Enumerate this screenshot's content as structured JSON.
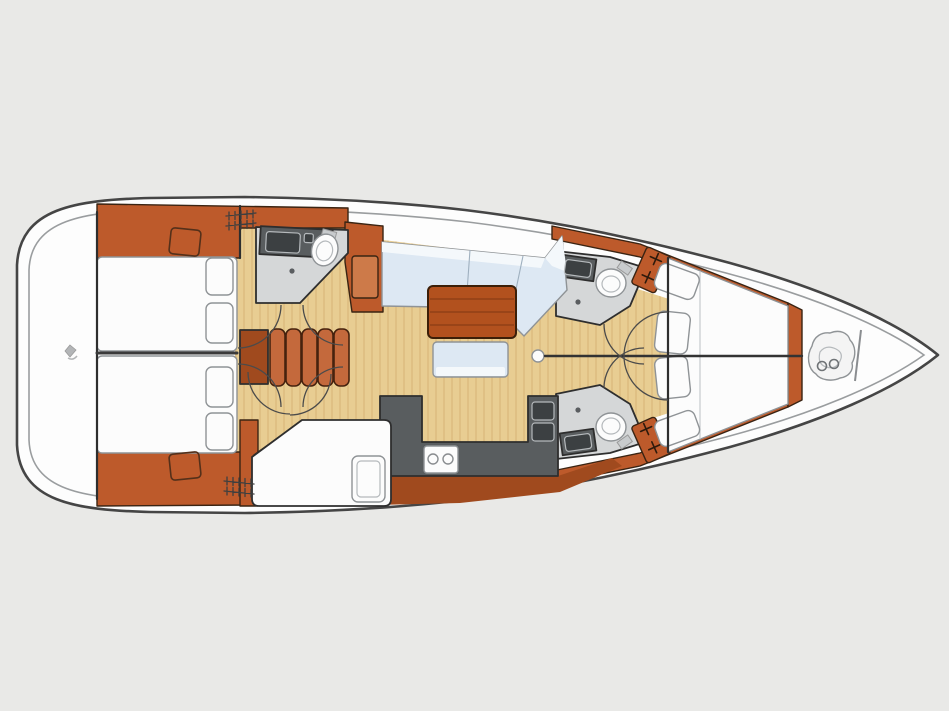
{
  "diagram": {
    "type": "yacht-interior-floor-plan",
    "view": "overhead",
    "bow_direction": "right",
    "stern_direction": "left"
  },
  "colors": {
    "background": "#e9e9e7",
    "hull_white": "#fdfdfd",
    "hull_outline": "#454545",
    "deck_line": "#9a9d9f",
    "wood_floor": "#e8cd92",
    "wood_floor_stripe": "#d2ae6e",
    "cabinetry_orange": "#bd5a2b",
    "cabinetry_shade": "#a04a1e",
    "cabinetry_light": "#cd7a49",
    "stair_tread": "#c4693c",
    "table_wood": "#b2511e",
    "upholstery_blue": "#dde8f3",
    "upholstery_white": "#f4f8fb",
    "counter_gray": "#595d5f",
    "sink_dark": "#3c4042",
    "head_floor_gray": "#d5d7d8",
    "fixture_white": "#fcfcfc",
    "wall_line": "#2e2e2e"
  },
  "inventory": {
    "aft_double_berths": 2,
    "forward_v_berth": 1,
    "single_berths": 1,
    "heads": 3,
    "toilets": 3,
    "head_sinks": 3,
    "galley_sink_bowls": 2,
    "stove_burners": 2,
    "companionway_steps": 5,
    "pillows": 8,
    "hanging_lockers": 2,
    "door_swings": 10,
    "salon_table": 1,
    "salon_settee": 1,
    "salon_bench": 1,
    "mast_post": 1,
    "anchor_locker": 1
  }
}
